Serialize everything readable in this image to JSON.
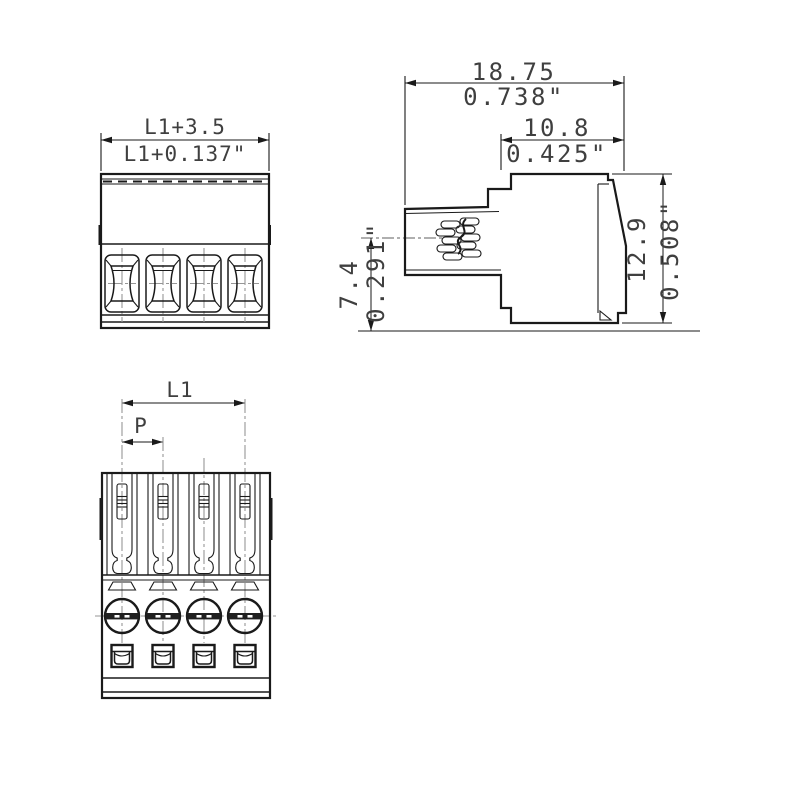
{
  "styles": {
    "line_color": "#1a1a1a",
    "centerline_color": "#969696",
    "text_color": "#3f3f3f",
    "background": "#ffffff"
  },
  "views": {
    "front": {
      "width_dim": {
        "metric": "L1+3.5",
        "inch": "L1+0.137\""
      }
    },
    "side": {
      "overall_width": {
        "metric": "18.75",
        "inch": "0.738\""
      },
      "body_width": {
        "metric": "10.8",
        "inch": "0.425\""
      },
      "entry_height": {
        "metric": "7.4",
        "inch": "0.291\""
      },
      "overall_height": {
        "metric": "12.9",
        "inch": "0.508\""
      }
    },
    "top": {
      "length_dim": "L1",
      "pitch_dim": "P"
    }
  }
}
